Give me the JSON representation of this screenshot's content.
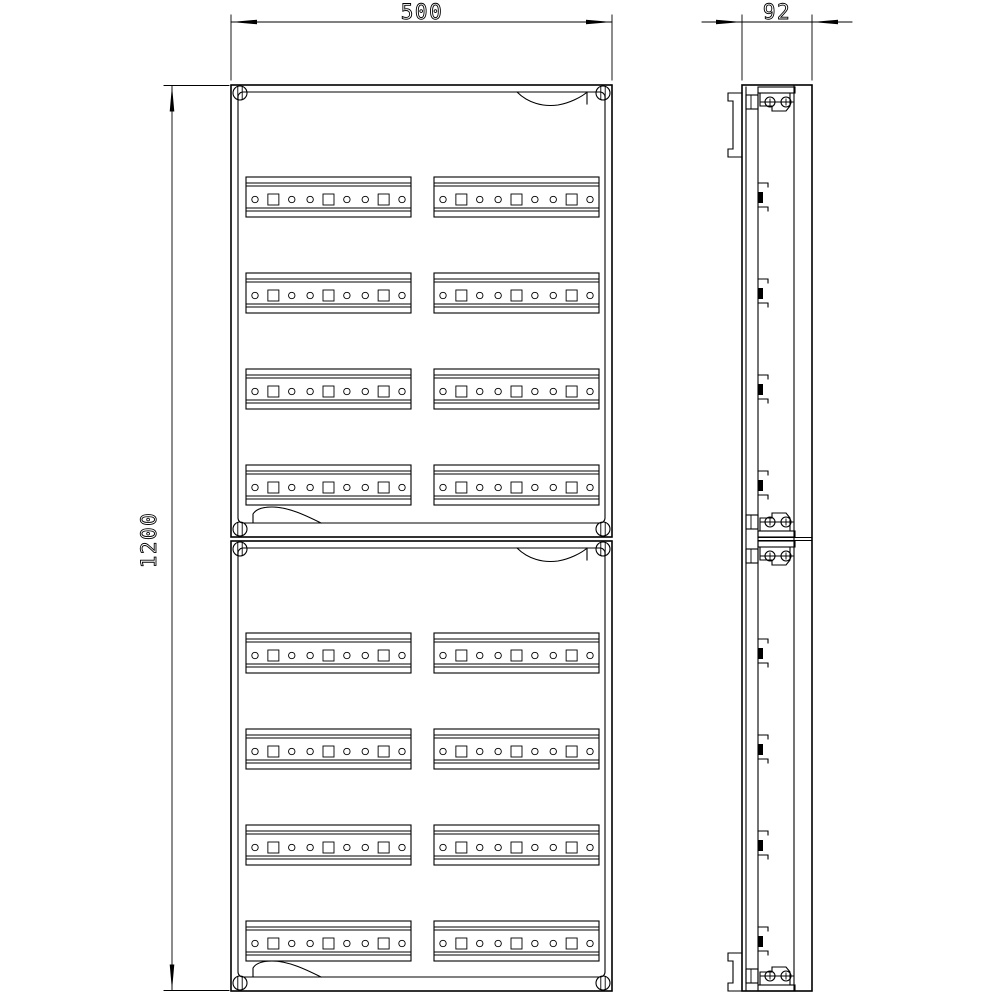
{
  "drawing": {
    "type": "CAD technical drawing",
    "subject": "DIN-rail distribution enclosure with two stacked cover sections",
    "views": [
      "front view",
      "side view"
    ]
  },
  "dimensions": {
    "width": "500",
    "depth": "92",
    "height": "1200"
  },
  "front_view": {
    "x": 231,
    "width": 381,
    "panels": [
      {
        "y": 85,
        "height": 452
      },
      {
        "y": 541,
        "height": 450
      }
    ],
    "inner_inset": {
      "side": 7,
      "top": 7,
      "bottom": 14,
      "corner_radius": 5
    },
    "screws": {
      "inset_x": 9,
      "inset_y": 8,
      "radius": 7
    },
    "rails": {
      "columns_x": [
        246,
        434
      ],
      "width": 165,
      "height": 40,
      "rows_per_panel": 4,
      "first_row_offset": 92,
      "row_spacing": 96,
      "band_offsets": [
        6,
        9,
        31,
        34
      ],
      "holes": {
        "count": 9,
        "edge_inset": 9,
        "center_y": 22.5,
        "pattern": [
          "circle",
          "square",
          "circle",
          "circle",
          "square",
          "circle",
          "circle",
          "square",
          "circle"
        ],
        "circle_radius": 3.2,
        "square_size": 11
      }
    },
    "handle_recess": {
      "top_right_offset": 88,
      "bottom_left_offset": 15
    }
  },
  "side_view": {
    "top": 85,
    "bottom": 991,
    "x_lines": {
      "cover_face": 742,
      "cover_back": 746,
      "mounting_plate": 758,
      "inner_wall": 794,
      "outer_right": 812
    },
    "mounting_tabs": {
      "outer_x": 728,
      "step_x": 733,
      "top_span": [
        93,
        157
      ],
      "bottom_span": [
        953,
        991
      ]
    },
    "junction_y": [
      537.5,
      540.5
    ],
    "brackets": [
      {
        "plate_y": 87,
        "dir": "down"
      },
      {
        "plate_y": 531,
        "dir": "up"
      },
      {
        "plate_y": 541,
        "dir": "down"
      },
      {
        "plate_y": 985,
        "dir": "up"
      }
    ],
    "rail_clip_centers": [
      197,
      293,
      389,
      485,
      653,
      749,
      845,
      941
    ]
  },
  "dimension_layout": {
    "width": {
      "line_y": 22,
      "ext_from": 15,
      "ext_to": 80,
      "arrow_len": 26
    },
    "depth": {
      "line_y": 22,
      "overhang": 40
    },
    "height": {
      "line_x": 172,
      "ext_from_x": 164,
      "ext_to_x": 229
    }
  }
}
